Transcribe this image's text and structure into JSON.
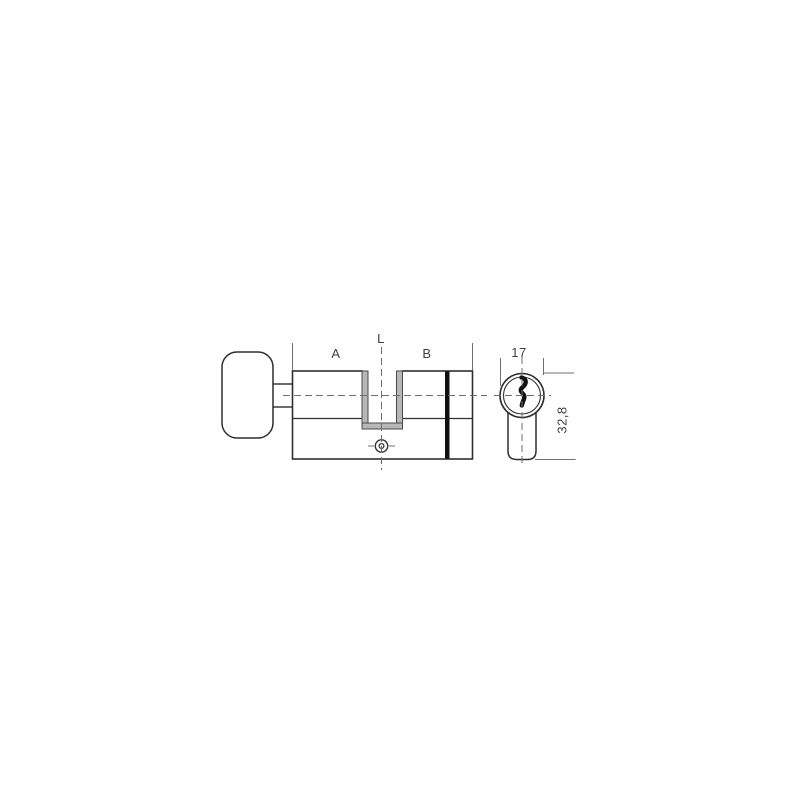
{
  "diagram": {
    "labels": {
      "segment_a": "A",
      "total_length": "L",
      "segment_b": "B",
      "diameter": "17",
      "profile_height": "32,8"
    },
    "colors": {
      "outline": "#2e2e2e",
      "dimension": "#6f6f6f",
      "cam_shade": "#b7b7b7",
      "ring_mark": "#101010"
    }
  }
}
